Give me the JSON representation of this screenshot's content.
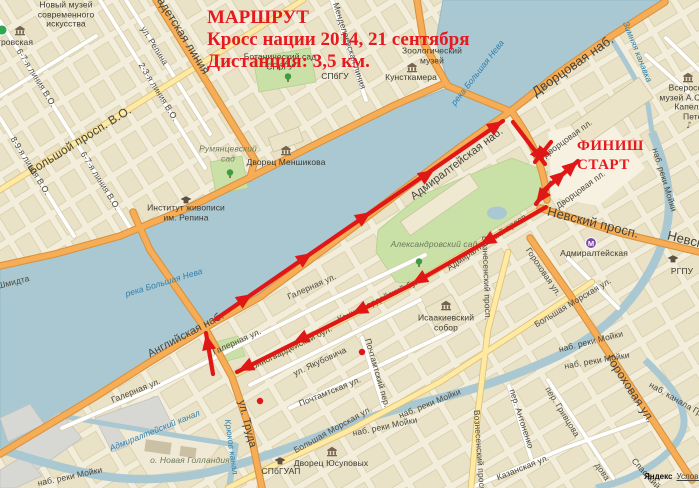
{
  "title": {
    "line1": "МАРШРУТ",
    "line2": "Кросс нации 2014, 21 сентября",
    "line3": "Дистанция: 3,5 км."
  },
  "route_labels": {
    "finish": "ФИНИШ",
    "start": "СТАРТ"
  },
  "attribution": {
    "brand": "Яндекс",
    "terms": "Условия"
  },
  "colors": {
    "route": "#e01717",
    "title": "#e6191f",
    "water": "#a9c8d2",
    "land": "#f3eedb",
    "road_major": "#f6ad55",
    "road_yellow": "#ffe9a3",
    "road_minor": "#ffffff",
    "park": "#c9e0a6"
  },
  "map_labels": [
    {
      "name": "label-novy-muzey",
      "text": "Новый музей современного искусства",
      "x": 66,
      "y": 15,
      "cls": "poi",
      "w": 95
    },
    {
      "name": "label-trovskaya",
      "text": "тровская",
      "x": 15,
      "y": 43,
      "cls": "poi"
    },
    {
      "name": "label-liniya-67-1",
      "text": "6-7-я линия В.О.",
      "x": 36,
      "y": 78,
      "rot": 58,
      "cls": "st"
    },
    {
      "name": "label-liniya-67-2",
      "text": "6-7-я линия В.О.",
      "x": 100,
      "y": 181,
      "rot": 58,
      "cls": "st"
    },
    {
      "name": "label-liniya-89",
      "text": "8-9-я линия В.О.",
      "x": 30,
      "y": 166,
      "rot": 58,
      "cls": "st"
    },
    {
      "name": "label-liniya-23",
      "text": "2-3-я линия В.О.",
      "x": 158,
      "y": 92,
      "rot": 58,
      "cls": "st"
    },
    {
      "name": "label-ul-repina",
      "text": "ул. Репина",
      "x": 154,
      "y": 46,
      "rot": 58,
      "cls": "st"
    },
    {
      "name": "label-kadetskaya-liniya",
      "text": "Кадетская линия",
      "x": 181,
      "y": 33,
      "rot": 58,
      "cls": "stb",
      "fs": 12
    },
    {
      "name": "label-mendeleevskaya",
      "text": "Менделеевская линия",
      "x": 349,
      "y": 46,
      "rot": 72,
      "cls": "st"
    },
    {
      "name": "label-botanichesky-sad",
      "text": "Ботанический сад СПбГУ",
      "x": 280,
      "y": 62,
      "cls": "poi",
      "w": 78
    },
    {
      "name": "label-spbgu",
      "text": "СПбГУ",
      "x": 335,
      "y": 77,
      "cls": "poi"
    },
    {
      "name": "label-zoologichesky-muzey",
      "text": "Зоологический музей",
      "x": 432,
      "y": 56,
      "cls": "poi",
      "w": 66
    },
    {
      "name": "label-kunstkamera",
      "text": "Кунсткамера",
      "x": 411,
      "y": 78,
      "cls": "poi"
    },
    {
      "name": "label-bolshoy-prosp-vo",
      "text": "Большой просп. В.О.",
      "x": 80,
      "y": 141,
      "rot": -32,
      "cls": "stb",
      "fs": 12
    },
    {
      "name": "label-rumyantsevsky-sad",
      "text": "Румянцевский сад",
      "x": 228,
      "y": 154,
      "cls": "park",
      "w": 64
    },
    {
      "name": "label-dvorets-menshikova",
      "text": "Дворец Меншикова",
      "x": 286,
      "y": 163,
      "cls": "poi"
    },
    {
      "name": "label-institut-repina",
      "text": "Институт живописи им. Репина",
      "x": 186,
      "y": 213,
      "cls": "poi",
      "w": 92
    },
    {
      "name": "label-reka-neva-1",
      "text": "река Большая Нева",
      "x": 478,
      "y": 73,
      "rot": -52,
      "cls": "wat"
    },
    {
      "name": "label-reka-neva-2",
      "text": "река Большая Нева",
      "x": 164,
      "y": 283,
      "rot": -17,
      "cls": "wat"
    },
    {
      "name": "label-nab-shmidta",
      "text": "наб. Лейтенанта Шмидта",
      "x": -20,
      "y": 291,
      "rot": -14,
      "cls": "st"
    },
    {
      "name": "label-dvortsovaya-nab",
      "text": "Дворцовая наб.",
      "x": 573,
      "y": 66,
      "rot": -35,
      "cls": "stb",
      "fs": 13
    },
    {
      "name": "label-zimnyaya-kanavka",
      "text": "Зимняя канавка",
      "x": 637,
      "y": 52,
      "rot": 68,
      "cls": "wat"
    },
    {
      "name": "label-vserossiysky-muzey",
      "text": "Всероссийский музей А.С.Пушкина",
      "x": 699,
      "y": 93,
      "cls": "poi",
      "w": 86
    },
    {
      "name": "label-kapella",
      "text": "Капелла Санкт-Петербурга",
      "x": 706,
      "y": 112,
      "cls": "poi",
      "w": 72
    },
    {
      "name": "label-dvortsovaya-pl-1",
      "text": "Дворцовая пл.",
      "x": 568,
      "y": 139,
      "rot": -36,
      "cls": "st"
    },
    {
      "name": "label-dvortsovaya-pl-2",
      "text": "Дворцовая пл.",
      "x": 581,
      "y": 190,
      "rot": -36,
      "cls": "st"
    },
    {
      "name": "label-admiralteyskaya-nab",
      "text": "Адмиралтейская наб.",
      "x": 457,
      "y": 164,
      "rot": -37,
      "cls": "stb",
      "fs": 11
    },
    {
      "name": "label-nevsky-prosp-1",
      "text": "Невский просп.",
      "x": 593,
      "y": 223,
      "rot": 14,
      "cls": "stb",
      "fs": 13
    },
    {
      "name": "label-nevsky-prosp-2",
      "text": "Невский просп.",
      "x": 713,
      "y": 247,
      "rot": 14,
      "cls": "stb",
      "fs": 13
    },
    {
      "name": "label-admiralteyskaya-metro",
      "text": "Адмиралтейская",
      "x": 594,
      "y": 254,
      "cls": "poi"
    },
    {
      "name": "label-nab-moyki-vert",
      "text": "наб. реки Мойки",
      "x": 664,
      "y": 180,
      "rot": 73,
      "cls": "st"
    },
    {
      "name": "label-aleksandrovsky-sad",
      "text": "Александровский сад",
      "x": 434,
      "y": 245,
      "cls": "park",
      "w": 88
    },
    {
      "name": "label-admiralteysky-prosp",
      "text": "Адмиралтейский просп.",
      "x": 488,
      "y": 242,
      "rot": -34,
      "cls": "st"
    },
    {
      "name": "label-gorokhovaya-1",
      "text": "Гороховая ул.",
      "x": 543,
      "y": 272,
      "rot": 56,
      "cls": "st"
    },
    {
      "name": "label-bolshaya-morskaya-1",
      "text": "Большая Морская ул.",
      "x": 573,
      "y": 303,
      "rot": -31,
      "cls": "st"
    },
    {
      "name": "label-isaakievsky-sobor",
      "text": "Исаакиевский собор",
      "x": 446,
      "y": 323,
      "cls": "poi",
      "w": 72
    },
    {
      "name": "label-voznesensky-1",
      "text": "Вознесенский просп.",
      "x": 486,
      "y": 278,
      "rot": 88,
      "cls": "st"
    },
    {
      "name": "label-galernaya-1",
      "text": "Галерная ул.",
      "x": 312,
      "y": 287,
      "rot": -24,
      "cls": "st"
    },
    {
      "name": "label-galernaya-2",
      "text": "Галерная ул.",
      "x": 237,
      "y": 342,
      "rot": -24,
      "cls": "st"
    },
    {
      "name": "label-galernaya-3",
      "text": "Галерная ул.",
      "x": 136,
      "y": 391,
      "rot": -22,
      "cls": "st"
    },
    {
      "name": "label-angliyskaya-nab",
      "text": "Английская наб.",
      "x": 186,
      "y": 335,
      "rot": -28,
      "cls": "stb",
      "fs": 11
    },
    {
      "name": "label-konnogvardeysky-1",
      "text": "Конногвардейский бул.",
      "x": 290,
      "y": 349,
      "rot": -26,
      "cls": "st"
    },
    {
      "name": "label-konnogvardeysky-2",
      "text": "Конногвардейский бул.",
      "x": 380,
      "y": 300,
      "rot": -26,
      "cls": "st"
    },
    {
      "name": "label-yakubovicha",
      "text": "ул. Якубовича",
      "x": 320,
      "y": 362,
      "rot": -25,
      "cls": "st"
    },
    {
      "name": "label-pochtamtsky-per",
      "text": "Почтамтский пер.",
      "x": 377,
      "y": 373,
      "rot": 74,
      "cls": "st"
    },
    {
      "name": "label-pochtamtskaya-ul",
      "text": "Почтамтская ул.",
      "x": 330,
      "y": 392,
      "rot": -22,
      "cls": "st"
    },
    {
      "name": "label-ul-truda",
      "text": "ул. Труда",
      "x": 247,
      "y": 424,
      "rot": 76,
      "cls": "stb",
      "fs": 11
    },
    {
      "name": "label-kryukov-kanal",
      "text": "Крюков канал",
      "x": 231,
      "y": 447,
      "rot": 82,
      "cls": "wat"
    },
    {
      "name": "label-admiralteysky-kanal",
      "text": "Адмиралтейский канал",
      "x": 155,
      "y": 431,
      "rot": -22,
      "cls": "wat"
    },
    {
      "name": "label-novaya-gollandiya",
      "text": "о. Новая Голландия",
      "x": 190,
      "y": 461,
      "cls": "park"
    },
    {
      "name": "label-bolshaya-morskaya-2",
      "text": "Большая Морская ул.",
      "x": 333,
      "y": 430,
      "rot": -29,
      "cls": "st"
    },
    {
      "name": "label-nab-moyki-1",
      "text": "наб. реки Мойки",
      "x": 430,
      "y": 404,
      "rot": -22,
      "cls": "st"
    },
    {
      "name": "label-nab-moyki-2",
      "text": "наб. реки Мойки",
      "x": 385,
      "y": 427,
      "rot": -12,
      "cls": "st"
    },
    {
      "name": "label-nab-moyki-3",
      "text": "наб. реки Мойки",
      "x": 591,
      "y": 342,
      "rot": -14,
      "cls": "st"
    },
    {
      "name": "label-nab-moyki-4",
      "text": "наб. реки Мойки",
      "x": 597,
      "y": 361,
      "rot": -10,
      "cls": "st"
    },
    {
      "name": "label-nab-moyki-5",
      "text": "наб. реки Мойки",
      "x": 70,
      "y": 477,
      "rot": -12,
      "cls": "st"
    },
    {
      "name": "label-spbguap",
      "text": "СПбГУАП",
      "x": 281,
      "y": 472,
      "cls": "poi"
    },
    {
      "name": "label-dvorets-yusupovykh",
      "text": "Дворец Юсуповых",
      "x": 331,
      "y": 464,
      "cls": "poi"
    },
    {
      "name": "label-per-antonenko",
      "text": "пер. Антоненко",
      "x": 521,
      "y": 419,
      "rot": 72,
      "cls": "st"
    },
    {
      "name": "label-per-grivtsova",
      "text": "пер. Гривцова",
      "x": 562,
      "y": 412,
      "rot": 58,
      "cls": "st"
    },
    {
      "name": "label-kazanskaya-ul",
      "text": "Казанская ул.",
      "x": 523,
      "y": 468,
      "rot": -22,
      "cls": "st"
    },
    {
      "name": "label-nab-kanala-griboedova",
      "text": "наб. канала Грибоедова",
      "x": 692,
      "y": 409,
      "rot": 30,
      "cls": "st"
    },
    {
      "name": "label-griboedova-partial",
      "text": "дова",
      "x": 602,
      "y": 472,
      "rot": 55,
      "cls": "st"
    },
    {
      "name": "label-spassky-per",
      "text": "Спасский пер.",
      "x": 652,
      "y": 481,
      "rot": 48,
      "cls": "st"
    },
    {
      "name": "label-voznesensky-2",
      "text": "Вознесенский просп.",
      "x": 479,
      "y": 452,
      "rot": 86,
      "cls": "st"
    },
    {
      "name": "label-gorokhovaya-2",
      "text": "Гороховая ул.",
      "x": 630,
      "y": 389,
      "rot": 57,
      "cls": "stb",
      "fs": 12
    },
    {
      "name": "label-rgpu",
      "text": "РГПУ",
      "x": 682,
      "y": 272,
      "cls": "poi"
    }
  ],
  "icons": [
    {
      "type": "metro2",
      "name": "metro-icon-green",
      "x": 2,
      "y": 30
    },
    {
      "type": "museum",
      "name": "museum-icon",
      "x": 20,
      "y": 31
    },
    {
      "type": "museum",
      "name": "museum-icon",
      "x": 286,
      "y": 151
    },
    {
      "type": "museum",
      "name": "museum-icon",
      "x": 412,
      "y": 68
    },
    {
      "type": "museum",
      "name": "museum-icon",
      "x": 446,
      "y": 306
    },
    {
      "type": "museum",
      "name": "museum-icon",
      "x": 688,
      "y": 78
    },
    {
      "type": "museum",
      "name": "museum-icon",
      "x": 332,
      "y": 452
    },
    {
      "type": "univ",
      "name": "university-icon",
      "x": 186,
      "y": 200
    },
    {
      "type": "univ",
      "name": "university-icon",
      "x": 673,
      "y": 259
    },
    {
      "type": "univ",
      "name": "university-icon",
      "x": 280,
      "y": 461
    },
    {
      "type": "tree",
      "name": "tree-icon",
      "x": 230,
      "y": 174
    },
    {
      "type": "tree",
      "name": "tree-icon",
      "x": 288,
      "y": 78
    },
    {
      "type": "tree",
      "name": "tree-icon",
      "x": 419,
      "y": 263
    },
    {
      "type": "metro",
      "name": "metro-icon",
      "x": 591,
      "y": 243
    },
    {
      "type": "music",
      "name": "music-icon",
      "x": 689,
      "y": 125
    }
  ],
  "route_overlay": {
    "color": "#e01717",
    "segments": [
      {
        "name": "route-embankment",
        "points": [
          [
            216,
            319
          ],
          [
            503,
            121
          ]
        ]
      },
      {
        "name": "route-truda-north",
        "points": [
          [
            213,
            374
          ],
          [
            206,
            333
          ]
        ]
      },
      {
        "name": "route-konnogvardeysky",
        "points": [
          [
            409,
            286
          ],
          [
            237,
            372
          ]
        ]
      },
      {
        "name": "route-admiralteysky",
        "points": [
          [
            546,
            207
          ],
          [
            409,
            286
          ]
        ]
      },
      {
        "name": "route-bridge-turn",
        "points": [
          [
            513,
            122
          ],
          [
            545,
            164
          ]
        ]
      },
      {
        "name": "route-palace-in",
        "points": [
          [
            551,
            142
          ],
          [
            535,
            162
          ]
        ]
      },
      {
        "name": "route-palace-shuttle",
        "points": [
          [
            543,
            191
          ],
          [
            578,
            161
          ]
        ]
      },
      {
        "name": "route-palace-out",
        "points": [
          [
            551,
            183
          ],
          [
            536,
            204
          ]
        ]
      }
    ],
    "arrows": [
      {
        "x": 252,
        "y": 294,
        "deg": -34
      },
      {
        "x": 312,
        "y": 253,
        "deg": -34
      },
      {
        "x": 371,
        "y": 212,
        "deg": -34
      },
      {
        "x": 434,
        "y": 170,
        "deg": -34
      },
      {
        "x": 503,
        "y": 121,
        "deg": -34
      },
      {
        "x": 206,
        "y": 334,
        "deg": -101
      },
      {
        "x": 352,
        "y": 314,
        "deg": 154
      },
      {
        "x": 293,
        "y": 343,
        "deg": 154
      },
      {
        "x": 238,
        "y": 371,
        "deg": 154
      },
      {
        "x": 480,
        "y": 245,
        "deg": 150
      },
      {
        "x": 412,
        "y": 284,
        "deg": 150
      },
      {
        "x": 545,
        "y": 163,
        "deg": 53
      },
      {
        "x": 535,
        "y": 162,
        "deg": 128
      },
      {
        "x": 578,
        "y": 161,
        "deg": -41
      },
      {
        "x": 566,
        "y": 171,
        "deg": -41
      },
      {
        "x": 536,
        "y": 204,
        "deg": 126
      }
    ],
    "dots": [
      [
        362,
        352
      ],
      [
        260,
        401
      ]
    ]
  }
}
